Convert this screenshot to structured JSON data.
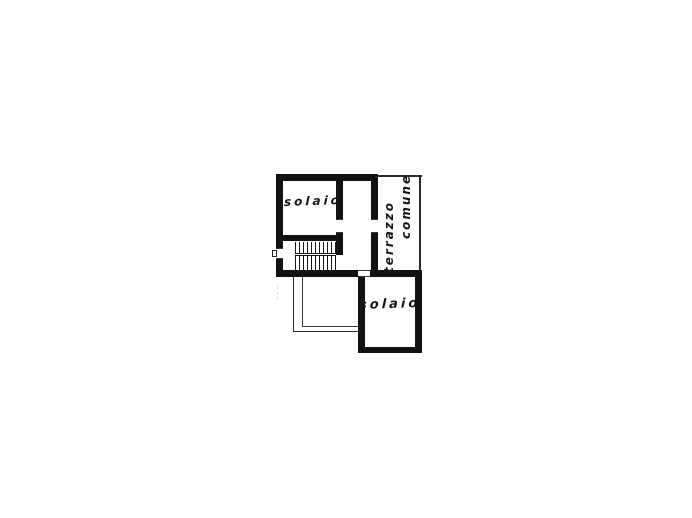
{
  "canvas": {
    "background": "#ffffff",
    "ink": "#121212"
  },
  "plan": {
    "rooms": {
      "solaio_upper": {
        "label": "solaio"
      },
      "terrace": {
        "word1": "terrazzo",
        "word2": "comune"
      },
      "solaio_lower": {
        "label": "solaio"
      }
    }
  }
}
